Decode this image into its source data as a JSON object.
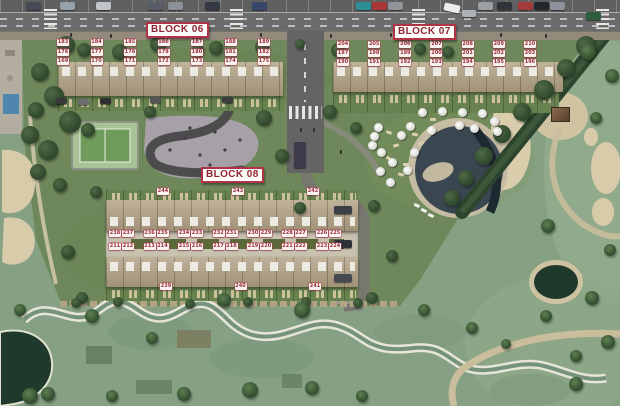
{
  "colors": {
    "badge_text": "#9e2b3e",
    "badge_bg": "#f7f4ef",
    "block_label_text": "#8f2433",
    "block_label_border": "#b03346",
    "road_gray": "#6b6b6b",
    "site_grass": "#6f885b",
    "golf_grass": "#86a084",
    "pool_water": "#3a4750",
    "sand": "#d8cba9"
  },
  "blocks": {
    "block06": {
      "label": "BLOCK 06",
      "row_top": [
        "183",
        "184",
        "185",
        "186",
        "187",
        "188",
        "189"
      ],
      "row_middle": [
        "176",
        "177",
        "178",
        "179",
        "180",
        "181",
        "182"
      ],
      "row_bottom": [
        "169",
        "170",
        "171",
        "172",
        "173",
        "174",
        "175"
      ]
    },
    "block07": {
      "label": "BLOCK 07",
      "row_top": [
        "204",
        "205",
        "206",
        "207",
        "208",
        "209",
        "210"
      ],
      "row_middle": [
        "197",
        "198",
        "199",
        "200",
        "201",
        "202",
        "203"
      ],
      "row_bottom": [
        "190",
        "191",
        "192",
        "193",
        "194",
        "195",
        "196"
      ]
    },
    "block08": {
      "label": "BLOCK 08",
      "row_upper": [
        "238",
        "237",
        "236",
        "235",
        "234",
        "233",
        "232",
        "231",
        "230",
        "229",
        "228",
        "227",
        "226",
        "225"
      ],
      "row_lower": [
        "211",
        "212",
        "213",
        "214",
        "215",
        "216",
        "217",
        "218",
        "219",
        "220",
        "221",
        "222",
        "223",
        "224"
      ],
      "corners_top": [
        "244",
        "243",
        "242"
      ],
      "corners_bottom": [
        "239",
        "240",
        "241"
      ]
    }
  }
}
